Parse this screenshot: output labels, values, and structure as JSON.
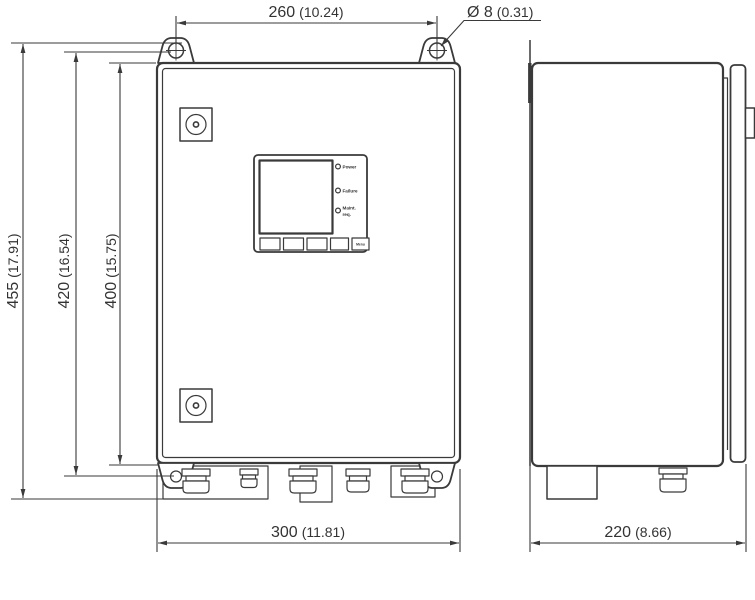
{
  "drawing": {
    "type": "technical dimension drawing",
    "views": {
      "front": "front view",
      "side": "side view"
    },
    "colors": {
      "line": "#3a3a3a",
      "text": "#333333",
      "background": "#ffffff"
    },
    "dimensions": {
      "lug_spacing": {
        "mm": "260",
        "inch": "(10.24)"
      },
      "hole_diameter": {
        "mm": "Ø 8",
        "inch": "(0.31)"
      },
      "overall_height": {
        "mm": "455",
        "inch": "(17.91)"
      },
      "mounting_height": {
        "mm": "420",
        "inch": "(16.54)"
      },
      "body_height": {
        "mm": "400",
        "inch": "(15.75)"
      },
      "body_width": {
        "mm": "300",
        "inch": "(11.81)"
      },
      "depth": {
        "mm": "220",
        "inch": "(8.66)"
      }
    },
    "panel": {
      "leds": [
        {
          "label": "Power"
        },
        {
          "label": "Failure"
        },
        {
          "label": "Maint.",
          "label2": "req."
        }
      ],
      "buttons": {
        "menu": "Menu"
      }
    }
  }
}
